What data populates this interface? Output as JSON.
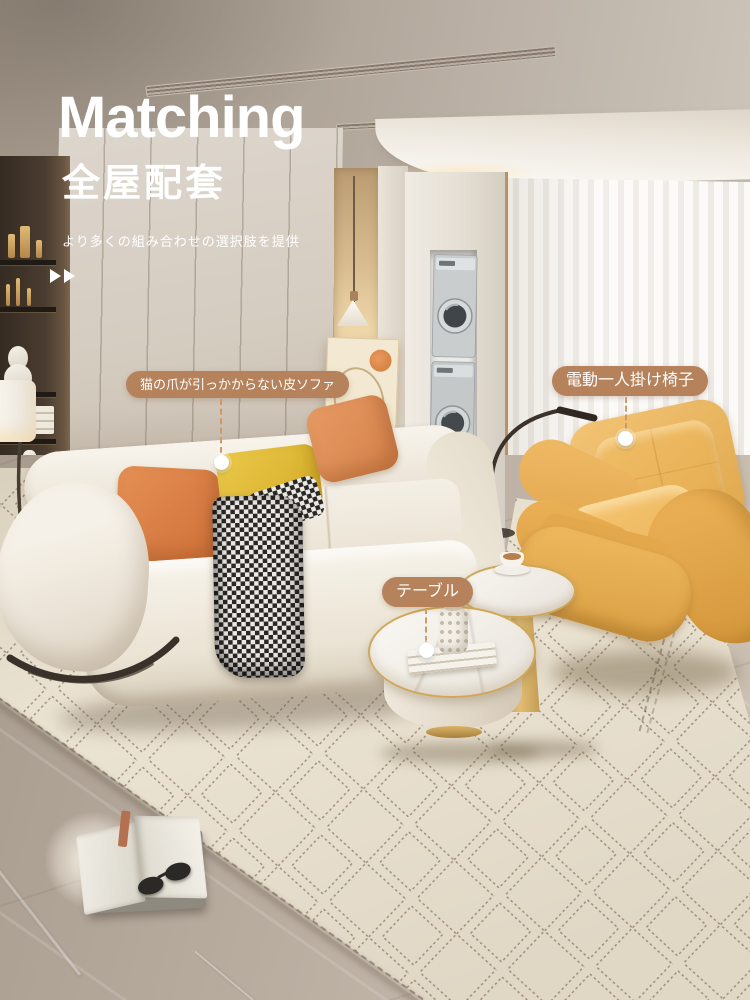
{
  "header": {
    "title": "Matching",
    "subtitle": "全屋配套",
    "tagline": "より多くの組み合わせの選択肢を提供"
  },
  "callouts": {
    "sofa": {
      "label": "猫の爪が引っかからない皮ソファ"
    },
    "chair": {
      "label": "電動一人掛け椅子"
    },
    "table": {
      "label": "テーブル"
    }
  },
  "colors": {
    "callout_bg": "#b5825c",
    "callout_line": "#cf9a64",
    "callout_dot": "#ffffff",
    "title_text": "#ffffff",
    "accent_wood": "#c8a276",
    "sofa_cream": "#f1ece1",
    "chair_yellow": "#ecb45f",
    "pillow_orange": "#e08c55",
    "pillow_yellow": "#e6c33e",
    "rug_bg": "#ece4d3",
    "rug_line": "#8d7b64",
    "floor_marble": "#b3a89c"
  }
}
